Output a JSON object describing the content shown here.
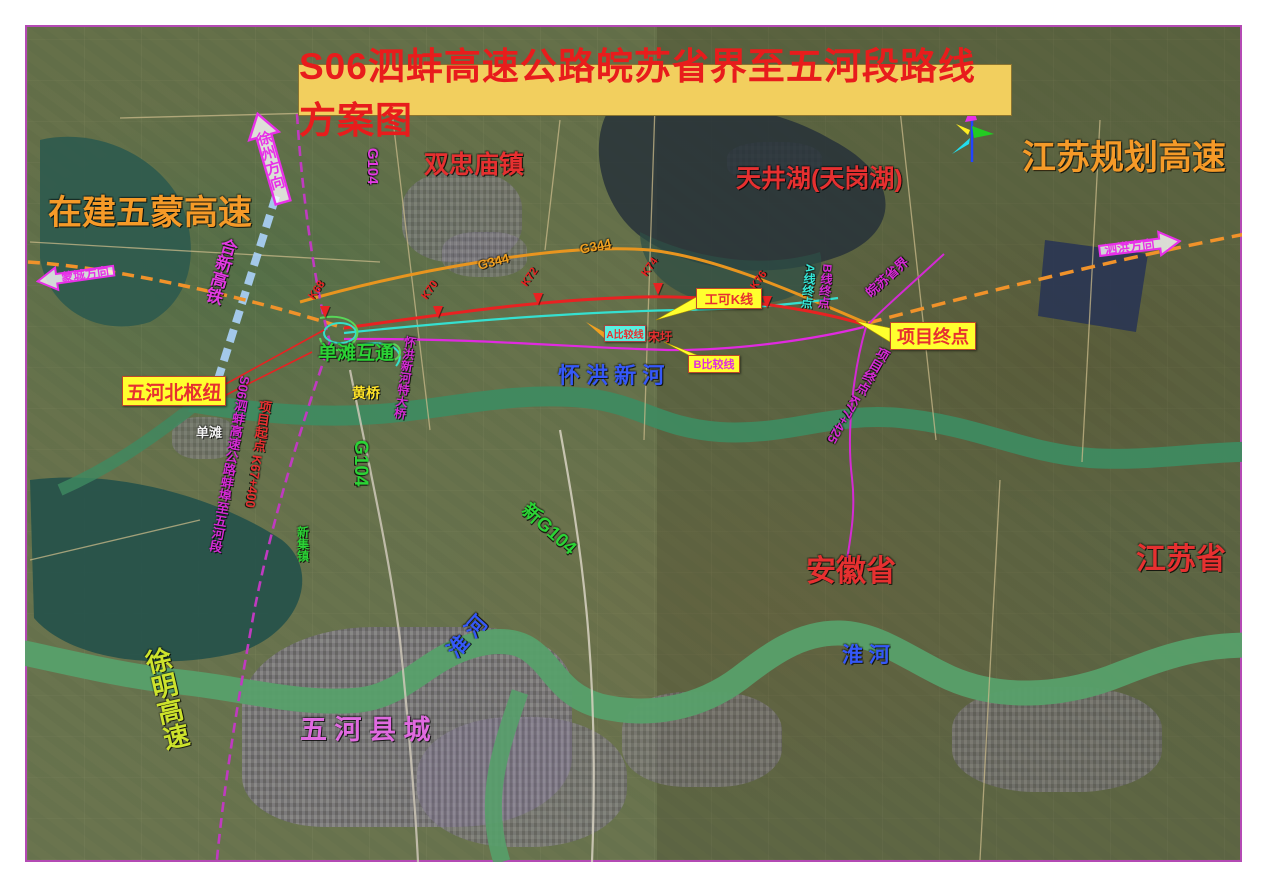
{
  "map": {
    "title": "S06泗蚌高速公路皖苏省界至五河段路线方案图",
    "colors": {
      "title_bg": "#f2cf5e",
      "title_text": "#e81c1c",
      "expressway_orange": "#f0922a",
      "k_line_red": "#e82222",
      "a_line_cyan": "#35e0d0",
      "b_line_magenta": "#e02ae0",
      "planned_purple": "#c03ac0",
      "railway_blue": "#a8cdf2",
      "river_green": "#4f9565",
      "label_blue": "#2f52f5",
      "label_green": "#2bd335",
      "callout_yellow": "#ffff2e"
    },
    "labels": [
      {
        "name": "label-wumeng-expwy-uc",
        "text": "在建五蒙高速",
        "x": 48,
        "y": 196,
        "size": 34,
        "color": "#f59a28"
      },
      {
        "name": "label-jiangsu-planned-expwy",
        "text": "江苏规划高速",
        "x": 1022,
        "y": 141,
        "size": 34,
        "color": "#f59a28"
      },
      {
        "name": "label-shuangzhongmiao-town",
        "text": "双忠庙镇",
        "x": 424,
        "y": 152,
        "size": 25,
        "color": "#e63030"
      },
      {
        "name": "label-tianjing-lake",
        "text": "天井湖(天岗湖)",
        "x": 736,
        "y": 166,
        "size": 25,
        "color": "#e63030"
      },
      {
        "name": "label-anhui-province",
        "text": "安徽省",
        "x": 806,
        "y": 556,
        "size": 30,
        "color": "#e63030"
      },
      {
        "name": "label-jiangsu-province",
        "text": "江苏省",
        "x": 1136,
        "y": 544,
        "size": 30,
        "color": "#e63030"
      },
      {
        "name": "label-huaihong-new-river",
        "text": "怀 洪 新 河",
        "x": 558,
        "y": 364,
        "size": 22,
        "color": "#3558f8"
      },
      {
        "name": "label-huaihe-river-west",
        "text": "淮 河",
        "x": 452,
        "y": 644,
        "size": 21,
        "color": "#3558f8",
        "rot": -48
      },
      {
        "name": "label-huaihe-river-east",
        "text": "淮 河",
        "x": 842,
        "y": 645,
        "size": 21,
        "color": "#3558f8"
      },
      {
        "name": "label-wuhe-county-town",
        "text": "五 河 县 城",
        "x": 300,
        "y": 716,
        "size": 27,
        "color": "#e06ae0"
      },
      {
        "name": "label-xuming-expwy",
        "text": "徐明高速",
        "x": 140,
        "y": 648,
        "size": 26,
        "color": "#cde32c",
        "vertical": true,
        "rot": -13
      },
      {
        "name": "label-g104-north",
        "text": "G104",
        "x": 372,
        "y": 140,
        "size": 15,
        "color": "#e23ae2",
        "rot": 90
      },
      {
        "name": "label-g104-south",
        "text": "G104",
        "x": 360,
        "y": 430,
        "size": 19,
        "color": "#2bd335",
        "rot": 90
      },
      {
        "name": "label-new-g104",
        "text": "新G104",
        "x": 524,
        "y": 498,
        "size": 19,
        "color": "#2bd335",
        "rot": 42
      },
      {
        "name": "label-dantan-interchange",
        "text": "单滩互通",
        "x": 318,
        "y": 344,
        "size": 19,
        "color": "#2bd335"
      },
      {
        "name": "label-huangqiao",
        "text": "黄桥",
        "x": 352,
        "y": 386,
        "size": 14,
        "color": "#ffe428"
      },
      {
        "name": "label-dantan",
        "text": "单滩",
        "x": 196,
        "y": 426,
        "size": 13,
        "color": "#f2f2f2"
      },
      {
        "name": "label-hexin-railway",
        "text": "合新高铁",
        "x": 220,
        "y": 238,
        "size": 17,
        "color": "#e23ae2",
        "vertical": true,
        "rot": 16
      },
      {
        "name": "label-s06-bengbu-wuhe-section",
        "text": "S06泗蚌高速公路蚌埠至五河段",
        "x": 238,
        "y": 376,
        "size": 13,
        "color": "#d42ad4",
        "vertical": true,
        "rot": 10
      },
      {
        "name": "label-project-start-chainage",
        "text": "项目起点 K67+400",
        "x": 258,
        "y": 400,
        "size": 13,
        "color": "#e63030",
        "vertical": true,
        "rot": 8
      },
      {
        "name": "label-project-end-chainage",
        "text": "项目终点 K77+425",
        "x": 878,
        "y": 348,
        "size": 13,
        "color": "#d42ad4",
        "vertical": true,
        "rot": 30
      },
      {
        "name": "label-a-line-end",
        "text": "A线终点",
        "x": 804,
        "y": 264,
        "size": 12,
        "color": "#35e8d8",
        "vertical": true,
        "rot": 6
      },
      {
        "name": "label-b-line-end",
        "text": "B线终点",
        "x": 821,
        "y": 264,
        "size": 12,
        "color": "#d42ad4",
        "vertical": true,
        "rot": 6
      },
      {
        "name": "label-provincial-border",
        "text": "皖苏省界",
        "x": 868,
        "y": 288,
        "size": 13,
        "color": "#d42ad4",
        "rot": -42
      },
      {
        "name": "label-huaihong-bridge",
        "text": "怀洪新河特大桥",
        "x": 404,
        "y": 336,
        "size": 12,
        "color": "#d42ad4",
        "vertical": true,
        "rot": 8
      },
      {
        "name": "label-xinji-town",
        "text": "新集镇",
        "x": 296,
        "y": 526,
        "size": 12,
        "color": "#2bd335",
        "vertical": true
      },
      {
        "name": "label-songwei-village",
        "text": "宋圩",
        "x": 648,
        "y": 331,
        "size": 12,
        "color": "#e63030"
      },
      {
        "name": "label-g344-west",
        "text": "G344",
        "x": 478,
        "y": 259,
        "size": 13,
        "color": "#f0a020",
        "rot": -14
      },
      {
        "name": "label-g344-east",
        "text": "G344",
        "x": 580,
        "y": 243,
        "size": 13,
        "color": "#f0a020",
        "rot": -12
      }
    ],
    "arrows": [
      {
        "name": "arrow-mengcheng-direction",
        "text": "蒙城方向",
        "x": 36,
        "y": 260,
        "w": 80,
        "h": 32,
        "dir": "left",
        "rot": -8
      },
      {
        "name": "arrow-xuzhou-direction",
        "text": "徐州方向",
        "x": 250,
        "y": 110,
        "w": 42,
        "h": 96,
        "dir": "up",
        "rot": -16
      },
      {
        "name": "arrow-sihong-direction",
        "text": "泗洪方向",
        "x": 1098,
        "y": 228,
        "w": 84,
        "h": 36,
        "dir": "right",
        "rot": -7
      }
    ],
    "callouts": [
      {
        "name": "callout-wuhebei-hub",
        "text": "五河北枢纽",
        "x": 122,
        "y": 376,
        "w": 102,
        "h": 28,
        "bg": "#ffff2e",
        "color": "#e63030",
        "size": 19
      },
      {
        "name": "callout-gongke-k-line",
        "text": "工可K线",
        "x": 696,
        "y": 288,
        "w": 64,
        "h": 19,
        "bg": "#ffff2e",
        "color": "#e63030",
        "size": 13
      },
      {
        "name": "callout-project-end",
        "text": "项目终点",
        "x": 890,
        "y": 322,
        "w": 84,
        "h": 26,
        "bg": "#ffff2e",
        "color": "#e63030",
        "size": 18
      },
      {
        "name": "callout-a-compare-line",
        "text": "A比较线",
        "x": 604,
        "y": 325,
        "w": 40,
        "h": 15,
        "bg": "#58f0e0",
        "color": "#e63030",
        "size": 10
      },
      {
        "name": "callout-b-compare-line",
        "text": "B比较线",
        "x": 688,
        "y": 355,
        "w": 50,
        "h": 16,
        "bg": "#ffff2e",
        "color": "#e02ae0",
        "size": 11
      }
    ],
    "chainage_markers": [
      {
        "name": "marker-k68",
        "text": "K68",
        "x": 320,
        "y": 306
      },
      {
        "name": "marker-k70",
        "text": "K70",
        "x": 433,
        "y": 306
      },
      {
        "name": "marker-k72",
        "text": "K72",
        "x": 533,
        "y": 293
      },
      {
        "name": "marker-k74",
        "text": "K74",
        "x": 653,
        "y": 283
      },
      {
        "name": "marker-k76",
        "text": "K76",
        "x": 762,
        "y": 296
      }
    ],
    "compass": {
      "name": "compass-icon",
      "x": 950,
      "y": 104,
      "colors": [
        "#2244ff",
        "#22cc22",
        "#e830e8",
        "#ffee22",
        "#22ddee"
      ]
    }
  }
}
